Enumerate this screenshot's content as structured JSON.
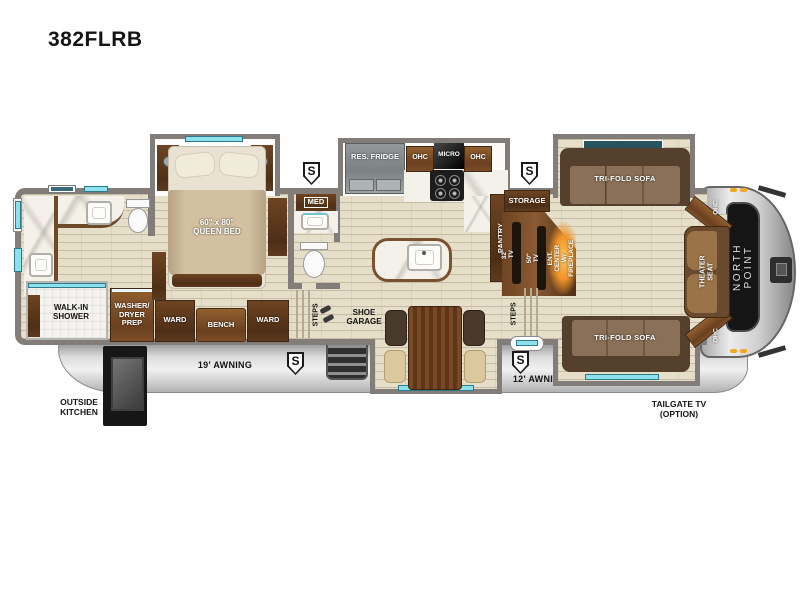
{
  "title": "382FLRB",
  "brand": "NORTH POINT",
  "floorplan": {
    "bathroom_rear": {
      "walk_in_shower": "WALK-IN\nSHOWER",
      "washer_dryer_prep": "WASHER/\nDRYER\nPREP"
    },
    "bedroom": {
      "queen_bed": "60\" x 80\"\nQUEEN BED",
      "ward_left": "WARD",
      "bench": "BENCH",
      "ward_right": "WARD",
      "steps": "STEPS"
    },
    "mid_bath": {
      "med_cabinet": "MED"
    },
    "entry": {
      "shoe_garage": "SHOE\nGARAGE"
    },
    "kitchen": {
      "res_fridge": "RES. FRIDGE",
      "ohc_left": "OHC",
      "micro": "MICRO",
      "ohc_right": "OHC",
      "pantry": "PANTRY"
    },
    "living_room": {
      "storage": "STORAGE",
      "tv_32": "32\" TV",
      "tv_50": "50\" TV",
      "ent_center": "ENT. CENTER\nW/ FIREPLACE",
      "steps": "STEPS",
      "sofa_top": "TRI-FOLD SOFA",
      "sofa_bottom": "TRI-FOLD SOFA",
      "theater_seat": "THEATER SEAT",
      "ohc_corner_top": "OHC",
      "ohc_corner_bottom": "OHC"
    }
  },
  "exterior": {
    "awning_rear": "19' AWNING",
    "awning_front": "12' AWNING",
    "outside_kitchen": "OUTSIDE\nKITCHEN",
    "tailgate_tv": "TAILGATE TV\n(OPTION)",
    "speaker_marker": "S"
  },
  "colors": {
    "accent_teal": "#8ce1ec",
    "wall_gray": "#827d78",
    "floor_beige": "#e5dec8",
    "wood_dark": "#5f3d22",
    "wood_mid": "#8a5a33",
    "sofa_brown": "#7d6750",
    "fireplace_glow": "#f09428",
    "skirt_silver": "#c9c9c9",
    "emblem_black": "#151515"
  }
}
